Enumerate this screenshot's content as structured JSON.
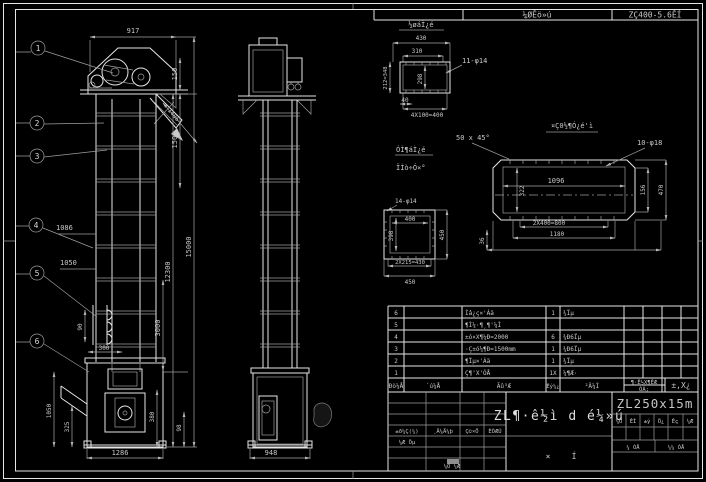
{
  "bar": {
    "c1": "¼ØÊö»ú",
    "c2": "ZÇ400-5.6ÊÍ"
  },
  "fv": {
    "b": [
      "1",
      "2",
      "3",
      "4",
      "5",
      "6"
    ],
    "d": {
      "top": "917",
      "r1": "150",
      "chute": "1486",
      "r2": "1500",
      "h1": "12300",
      "h2": "15000",
      "seg": "3000",
      "s1": "380",
      "s2": "98",
      "l1": "1086",
      "l2": "1050",
      "bk1": "90",
      "bk2": "300",
      "bt1": "1050",
      "bt2": "325",
      "bt3": "1286"
    }
  },
  "sv": {
    "w": "948"
  },
  "d1": {
    "t": "½øáÌ¿é",
    "v430": "430",
    "v310": "310",
    "holes": "11-φ14",
    "inner": "298",
    "left": "212=348",
    "v40": "40",
    "bottom": "4X100=400"
  },
  "d2": {
    "t1": "ÓÌ¶áÌ¿é",
    "t2": "ÏÌò÷Ó×°",
    "holes": "14-φ14",
    "w": "400",
    "h": "398",
    "right": "450",
    "b1": "2X215=430",
    "b2": "450"
  },
  "d3": {
    "t": "¤Ç0½¶Ó¿é'ì",
    "ch": "50 x 45°",
    "holes": "10-φ18",
    "w": "1096",
    "h": "322",
    "r1": "156",
    "r2": "470",
    "b1": "2X400=800",
    "b2": "1180",
    "left": "36"
  },
  "pt": {
    "rows": [
      {
        "no": "6",
        "code": "",
        "name": "Íâ¿ç×'Áä",
        "qty": "1",
        "mat": "¾Ïµ"
      },
      {
        "no": "5",
        "code": "",
        "name": "¶Ì¼·¶¸¶'¼Ì",
        "qty": "",
        "mat": ""
      },
      {
        "no": "4",
        "code": "",
        "name": "±ó×X¶¼Ð=2000",
        "qty": "6",
        "mat": "¾Ð6Ïµ"
      },
      {
        "no": "3",
        "code": "",
        "name": "·Ç±ó¼¶Ð=1500mm",
        "qty": "1",
        "mat": "¾Ð6Ïµ"
      },
      {
        "no": "2",
        "code": "",
        "name": "¶Ïµ×'Áä",
        "qty": "1",
        "mat": "¾Ïµ"
      },
      {
        "no": "1",
        "code": "",
        "name": "Ç¶'X'ÓÅ",
        "qty": "1X",
        "mat": "¼¶Æ·"
      }
    ],
    "h": {
      "no": "Ðò¼Å",
      "code": "´ú¼Å",
      "name": "Ãû³Æ",
      "qty": "Êý¼¿",
      "mat": "²Ä¼Ì",
      "u1": "¶·Ê½X¶ÊÆ",
      "u2": "ÓÃ;",
      "rk": "±,X¿"
    }
  },
  "tb": {
    "name": "ZL¶·ê½ì d é¼»ú",
    "model": "ZL250x15m",
    "g1": "×",
    "g2": "Í",
    "r1": "±ð¼Ç(¼)",
    "r2": "¸Ä¼Ä¼þ",
    "r3": "Ç©×Ö",
    "r4": "ÈÕÆÚ",
    "s1": "¼Æ Öµ",
    "b1": "¼Õ ¼Æ",
    "c": [
      "¼Ö",
      "ÊÌ",
      "±ý",
      "Ö¿",
      "Êç",
      "¼Æ"
    ],
    "sh1": "¼ ÓÅ",
    "sh2": "¼¼ ÓÅ"
  }
}
